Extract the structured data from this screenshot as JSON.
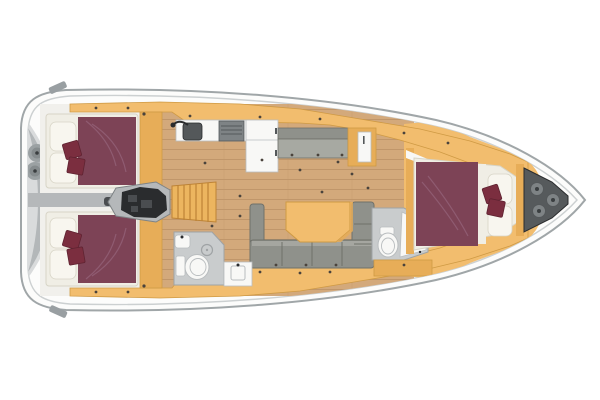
{
  "areas": {
    "stern": "stern-swim-platform",
    "aft_cabin_port": "aft-cabin-port",
    "aft_cabin_starboard": "aft-cabin-starboard",
    "engine": "engine-compartment",
    "companionway": "companionway-steps",
    "galley": "galley",
    "nav": "chart-table",
    "settee": "port-settee",
    "salon": "salon-lounge",
    "aft_head": "aft-bathroom",
    "fwd_head": "forward-bathroom",
    "fwd_cabin": "forward-owner-cabin",
    "anchor": "anchor-locker"
  },
  "palette": {
    "page_bg": "#ffffff",
    "hull_stroke": "#a0a6a8",
    "hull_fill": "#fcfcfb",
    "deck_line": "#ccd0d1",
    "transom_panel": "#d9dbdc",
    "transom_band": "#b3b7b9",
    "winch_ring": "#9ba1a3",
    "winch_face": "#868c8e",
    "winch_dot": "#3a3e40",
    "pad": "#999fa2",
    "cabinetry": "#f2bd6e",
    "cabinetry_dark": "#cf9a44",
    "cabinetry_deep": "#e7ad58",
    "wood": "#d3a97b",
    "wood_line": "#c0966a",
    "wall": "#f1f0ec",
    "linen": "#f0eee5",
    "linen_shadow": "#d7d4c6",
    "pillow": "#f8f6ef",
    "bed_maroon": "#7d4356",
    "bed_maroon_hl": "#946178",
    "cushion": "#7b2e3f",
    "cushion_dark": "#5f2331",
    "sofa": "#8f918b",
    "sofa_dark": "#6f716a",
    "sofa_light": "#a7a9a2",
    "fixture": "#f8f8f6",
    "fixture_line": "#b9bdbf",
    "shower": "#c9cccd",
    "shower_line": "#9fa3a5",
    "steel_dark": "#54585a",
    "steel": "#7e8385",
    "engine": "#2a2c2e",
    "engine_mid": "#4a4d50",
    "corridor": "#b5b8ba",
    "steps": "#ecb55f",
    "steps_line": "#bd8336",
    "locker": "#565a5c",
    "dot": "#4a433c"
  }
}
